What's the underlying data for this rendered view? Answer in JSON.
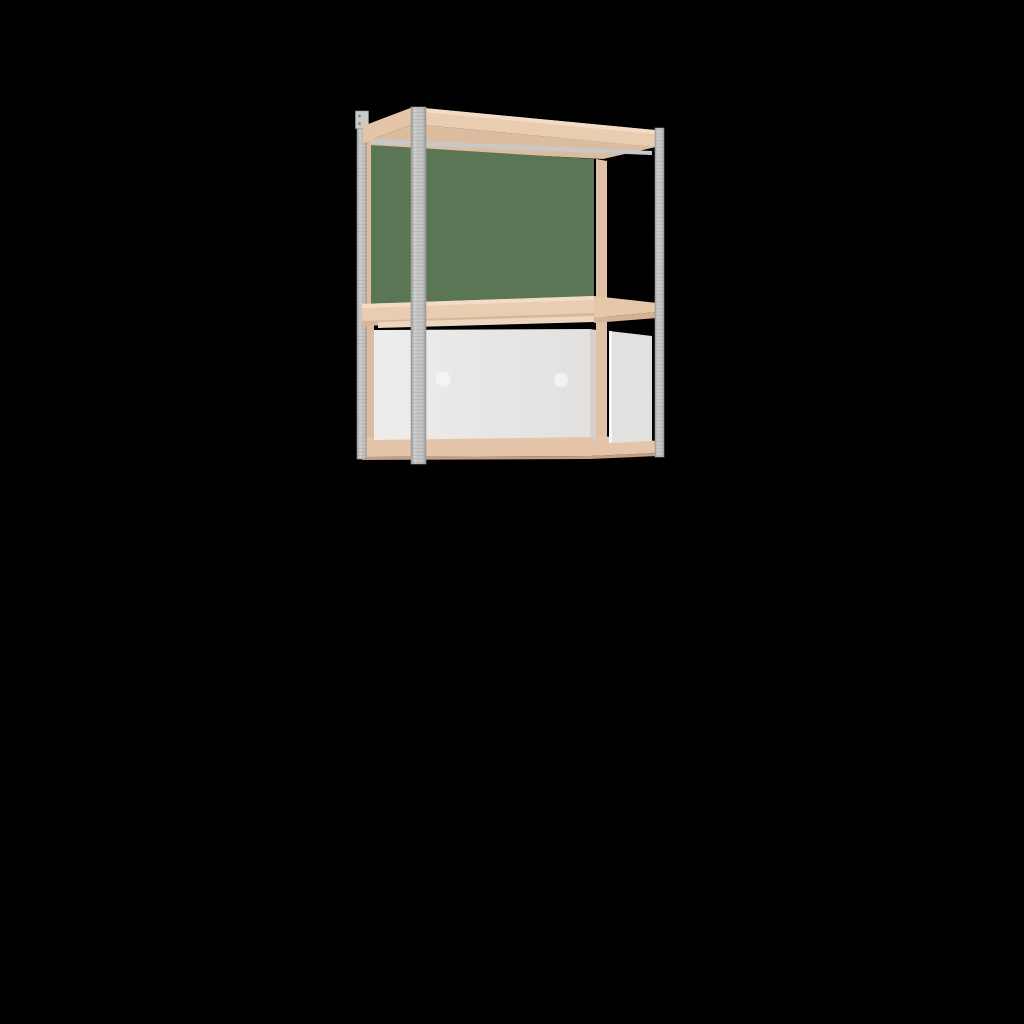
{
  "canvas": {
    "width": 1024,
    "height": 1024,
    "background": "#000000"
  },
  "scene": {
    "description": "3D product render of a two-tier wall-mounted shelf unit: galvanized steel posts, birch-tone wood rails and shelves, a green back panel in the open upper tier, and a white cabinet insert with two round finger holes in the lower tier, on a black background.",
    "palette": {
      "background": "#000000",
      "wood_front": "#e9cdb1",
      "wood_highlight": "#f2dcc6",
      "wood_side": "#e4c5a8",
      "wood_under": "#dcbc9f",
      "wood_rail": "#d9bca1",
      "wood_shadow": "#d5b294",
      "wood_under_edge": "#c49e80",
      "green_panel": "#5b7655",
      "metal_edge": "#9f9f9f",
      "metal_mid": "#cdcdcd",
      "metal_base": "#c2c2c2",
      "metal_dark": "#989898",
      "metal_stripe": "#c8c8c8",
      "perf_line": "#6f6f6f",
      "perf_streak": "#ffffff",
      "bracket": "#cacaca",
      "bracket_hole": "#7e7e7e",
      "panel_light": "#eeedeb",
      "panel_dark": "#e3e1df",
      "hole_light": "#f5f4f2",
      "side_panel": "#e2e1df",
      "side_panel_edge": "#f7f7f6",
      "gap_shadow": "#d8d0c8"
    },
    "parts": [
      {
        "name": "left-side-wood-rail",
        "shape": "polygon",
        "fill": "#d9bca1",
        "points": [
          [
            365,
            127
          ],
          [
            374,
            129
          ],
          [
            374,
            455
          ],
          [
            365,
            456
          ]
        ]
      },
      {
        "name": "rear-right-wood-post",
        "shape": "polygon",
        "fill": "#e0c1a5",
        "points": [
          [
            596,
            159
          ],
          [
            607,
            161
          ],
          [
            607,
            442
          ],
          [
            596,
            443
          ]
        ]
      },
      {
        "name": "top-board-underside",
        "shape": "polygon",
        "fill": "#dcbc9f",
        "points": [
          [
            363,
            143
          ],
          [
            413,
            124
          ],
          [
            656,
            147
          ],
          [
            603,
            159
          ],
          [
            371,
            147
          ]
        ]
      },
      {
        "name": "top-rear-metal-rail",
        "shape": "polygon",
        "fill": "#c8c8c8",
        "points": [
          [
            371,
            139
          ],
          [
            652,
            151
          ],
          [
            652,
            155
          ],
          [
            371,
            144
          ]
        ]
      },
      {
        "name": "back-panel-green",
        "shape": "polygon",
        "fill": "#5b7655",
        "points": [
          [
            371,
            145
          ],
          [
            594,
            159
          ],
          [
            594,
            297
          ],
          [
            371,
            305
          ]
        ]
      },
      {
        "name": "bottom-rail",
        "shape": "polygon",
        "fill": "#e5c5a9",
        "points": [
          [
            362,
            437
          ],
          [
            590,
            435
          ],
          [
            657,
            441
          ],
          [
            657,
            453
          ],
          [
            590,
            456
          ],
          [
            362,
            457
          ]
        ]
      },
      {
        "name": "bottom-rail-underside",
        "shape": "polygon",
        "fill": "#c49e80",
        "points": [
          [
            362,
            457
          ],
          [
            590,
            456
          ],
          [
            657,
            453
          ],
          [
            657,
            456
          ],
          [
            590,
            459
          ],
          [
            362,
            460
          ]
        ]
      },
      {
        "name": "rear-left-post",
        "shape": "rect",
        "fill": "@metal",
        "stroke": "#9a9a9a",
        "x": 357,
        "y": 114,
        "w": 9.5,
        "h": 345
      },
      {
        "name": "rear-left-post-texture",
        "shape": "rect",
        "fill": "@perf",
        "opacity": 0.35,
        "x": 357,
        "y": 114,
        "w": 9.5,
        "h": 345
      },
      {
        "name": "wall-bracket",
        "shape": "rect",
        "fill": "#cacaca",
        "stroke": "#949494",
        "x": 355.5,
        "y": 111,
        "w": 13,
        "h": 17.5
      },
      {
        "name": "wall-bracket-hole-top",
        "shape": "circle",
        "fill": "#7e7e7e",
        "cx": 359.5,
        "cy": 116,
        "r": 1.3
      },
      {
        "name": "wall-bracket-hole-bottom",
        "shape": "circle",
        "fill": "#7e7e7e",
        "cx": 359.5,
        "cy": 123.5,
        "r": 1.3
      },
      {
        "name": "middle-shelf-front",
        "shape": "polygon",
        "fill": "#e9cdb1",
        "points": [
          [
            362,
            304
          ],
          [
            594,
            296
          ],
          [
            594,
            318
          ],
          [
            362,
            326
          ]
        ]
      },
      {
        "name": "middle-shelf-front-highlight",
        "shape": "polygon",
        "fill": "#f2dcc6",
        "points": [
          [
            362,
            304
          ],
          [
            594,
            296
          ],
          [
            594,
            300
          ],
          [
            362,
            308
          ]
        ]
      },
      {
        "name": "middle-shelf-front-shadow",
        "shape": "polygon",
        "fill": "#d9b697",
        "points": [
          [
            362,
            321
          ],
          [
            594,
            313
          ],
          [
            594,
            318
          ],
          [
            362,
            326
          ]
        ]
      },
      {
        "name": "middle-shelf-right",
        "shape": "polygon",
        "fill": "#e5c7aa",
        "points": [
          [
            594,
            296
          ],
          [
            657,
            303
          ],
          [
            657,
            312
          ],
          [
            594,
            318
          ]
        ]
      },
      {
        "name": "middle-shelf-right-underside",
        "shape": "polygon",
        "fill": "#d5b294",
        "points": [
          [
            594,
            318
          ],
          [
            657,
            312
          ],
          [
            657,
            318
          ],
          [
            594,
            323
          ]
        ]
      },
      {
        "name": "middle-shelf-underside-sliver",
        "shape": "polygon",
        "fill": "#ecd6c0",
        "points": [
          [
            378,
            322
          ],
          [
            594,
            316
          ],
          [
            594,
            322
          ],
          [
            378,
            328
          ]
        ]
      },
      {
        "name": "cabinet-front-panel",
        "shape": "polygon",
        "fill": "@panel",
        "points": [
          [
            374,
            330
          ],
          [
            590,
            329
          ],
          [
            590,
            437
          ],
          [
            374,
            440
          ]
        ]
      },
      {
        "name": "finger-hole-left",
        "shape": "circle",
        "fill": "#f5f4f2",
        "cx": 443,
        "cy": 379,
        "r": 7.5
      },
      {
        "name": "finger-hole-right",
        "shape": "circle",
        "fill": "#f3f2f0",
        "cx": 561,
        "cy": 380,
        "r": 7
      },
      {
        "name": "panel-post-gap-shadow",
        "shape": "polygon",
        "fill": "#d8d0c8",
        "points": [
          [
            590,
            329
          ],
          [
            596,
            330
          ],
          [
            596,
            442
          ],
          [
            590,
            437
          ]
        ]
      },
      {
        "name": "side-panel",
        "shape": "polygon",
        "fill": "#e2e1df",
        "points": [
          [
            609,
            331
          ],
          [
            652,
            336
          ],
          [
            652,
            441
          ],
          [
            609,
            443
          ]
        ]
      },
      {
        "name": "side-panel-edge-highlight",
        "shape": "polygon",
        "fill": "#f7f7f6",
        "points": [
          [
            609,
            331
          ],
          [
            612,
            331
          ],
          [
            612,
            442
          ],
          [
            609,
            443
          ]
        ]
      },
      {
        "name": "top-front-rail",
        "shape": "polygon",
        "fill": "#e9cdb1",
        "points": [
          [
            413,
            107
          ],
          [
            655,
            130
          ],
          [
            655,
            147
          ],
          [
            413,
            124
          ]
        ]
      },
      {
        "name": "top-front-rail-highlight",
        "shape": "polygon",
        "fill": "#f2dcc6",
        "points": [
          [
            413,
            107
          ],
          [
            655,
            130
          ],
          [
            655,
            134
          ],
          [
            413,
            111
          ]
        ]
      },
      {
        "name": "top-left-rail",
        "shape": "polygon",
        "fill": "#e4c5a8",
        "points": [
          [
            363,
            126
          ],
          [
            413,
            107
          ],
          [
            413,
            124
          ],
          [
            363,
            143
          ]
        ]
      },
      {
        "name": "front-right-post",
        "shape": "rect",
        "fill": "@metal",
        "stroke": "#9a9a9a",
        "x": 655,
        "y": 128,
        "w": 9,
        "h": 329
      },
      {
        "name": "front-right-post-texture",
        "shape": "rect",
        "fill": "@perf",
        "opacity": 0.35,
        "x": 655,
        "y": 128,
        "w": 9,
        "h": 329
      },
      {
        "name": "front-left-post",
        "shape": "rect",
        "fill": "@metal",
        "stroke": "#9a9a9a",
        "x": 411,
        "y": 107,
        "w": 15,
        "h": 357
      },
      {
        "name": "front-left-post-texture",
        "shape": "rect",
        "fill": "@perf",
        "opacity": 0.4,
        "x": 411,
        "y": 107,
        "w": 15,
        "h": 357
      }
    ]
  }
}
